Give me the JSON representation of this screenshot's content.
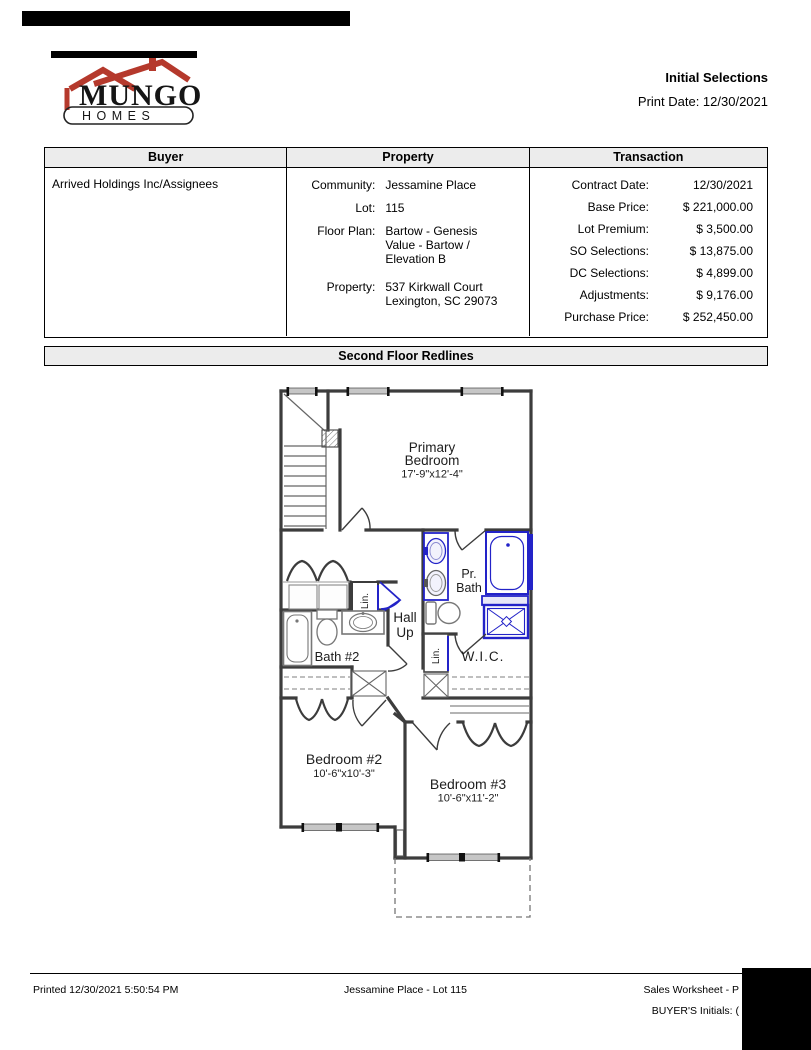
{
  "header": {
    "title": "Initial Selections",
    "print_date": "Print Date: 12/30/2021",
    "logo": {
      "line1": "MUNGO",
      "line2": "HOMES"
    }
  },
  "table": {
    "columns": [
      "Buyer",
      "Property",
      "Transaction"
    ],
    "buyer_name": "Arrived Holdings Inc/Assignees",
    "property": {
      "rows": [
        {
          "label": "Community:",
          "value": "Jessamine Place"
        },
        {
          "label": "Lot:",
          "value": "115"
        },
        {
          "label": "Floor Plan:",
          "value": "Bartow - Genesis Value - Bartow / Elevation B"
        },
        {
          "label": "Property:",
          "value": "537 Kirkwall Court\nLexington, SC 29073"
        }
      ]
    },
    "transaction": {
      "rows": [
        {
          "label": "Contract Date:",
          "value": "12/30/2021"
        },
        {
          "label": "Base Price:",
          "value": "$ 221,000.00"
        },
        {
          "label": "Lot Premium:",
          "value": "$ 3,500.00"
        },
        {
          "label": "SO Selections:",
          "value": "$ 13,875.00"
        },
        {
          "label": "DC Selections:",
          "value": "$ 4,899.00"
        },
        {
          "label": "Adjustments:",
          "value": "$ 9,176.00"
        },
        {
          "label": "Purchase Price:",
          "value": "$ 252,450.00"
        }
      ]
    }
  },
  "section_title": "Second Floor Redlines",
  "floorplan": {
    "labels": {
      "primary_1": "Primary",
      "primary_2": "Bedroom",
      "primary_dims": "17'-9\"x12'-4\"",
      "pr_bath_1": "Pr.",
      "pr_bath_2": "Bath",
      "hall_1": "Hall",
      "hall_2": "Up",
      "bath2": "Bath #2",
      "wic": "W.I.C.",
      "lin_hall": "Lin.",
      "lin_wic": "Lin.",
      "bedroom2": "Bedroom #2",
      "bedroom2_dims": "10'-6\"x10'-3\"",
      "bedroom3": "Bedroom #3",
      "bedroom3_dims": "10'-6\"x11'-2\""
    },
    "colors": {
      "redline": "#2323c8",
      "wall": "#3c3c3c"
    }
  },
  "footer": {
    "printed": "Printed 12/30/2021 5:50:54 PM",
    "center": "Jessamine Place - Lot 115",
    "right": "Sales Worksheet - P",
    "initials": "BUYER'S Initials: ("
  }
}
